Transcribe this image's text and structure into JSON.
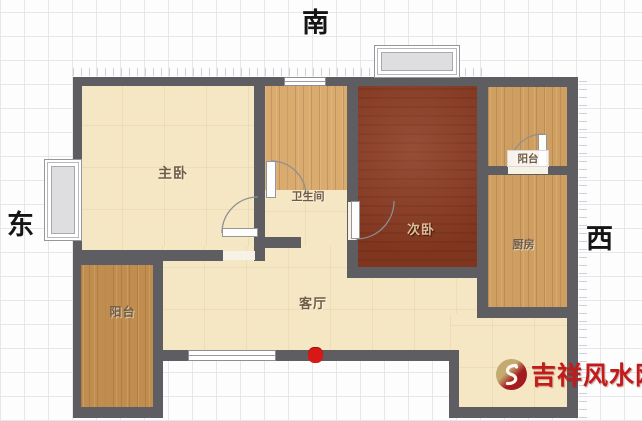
{
  "compass": {
    "south": "南",
    "east": "东",
    "west": "西"
  },
  "rooms": {
    "master_bedroom": {
      "label": "主卧"
    },
    "bathroom": {
      "label": "卫生间"
    },
    "second_bedroom": {
      "label": "次卧"
    },
    "balcony_top_right": {
      "label": "阳台"
    },
    "kitchen": {
      "label": "厨房"
    },
    "balcony_bottom_left": {
      "label": "阳台"
    },
    "living_room": {
      "label": "客厅"
    }
  },
  "watermark": {
    "site_name": "吉祥风水网"
  },
  "colors": {
    "wall": "#5e5e62",
    "floor_cream": "#f5e7c4",
    "floor_wood": "#cf9f62",
    "floor_dark_bedroom": "#8b3a21",
    "entry_marker_red": "#d81717",
    "watermark_red": "#c21b1b",
    "grid_line": "#e7e7eb"
  }
}
